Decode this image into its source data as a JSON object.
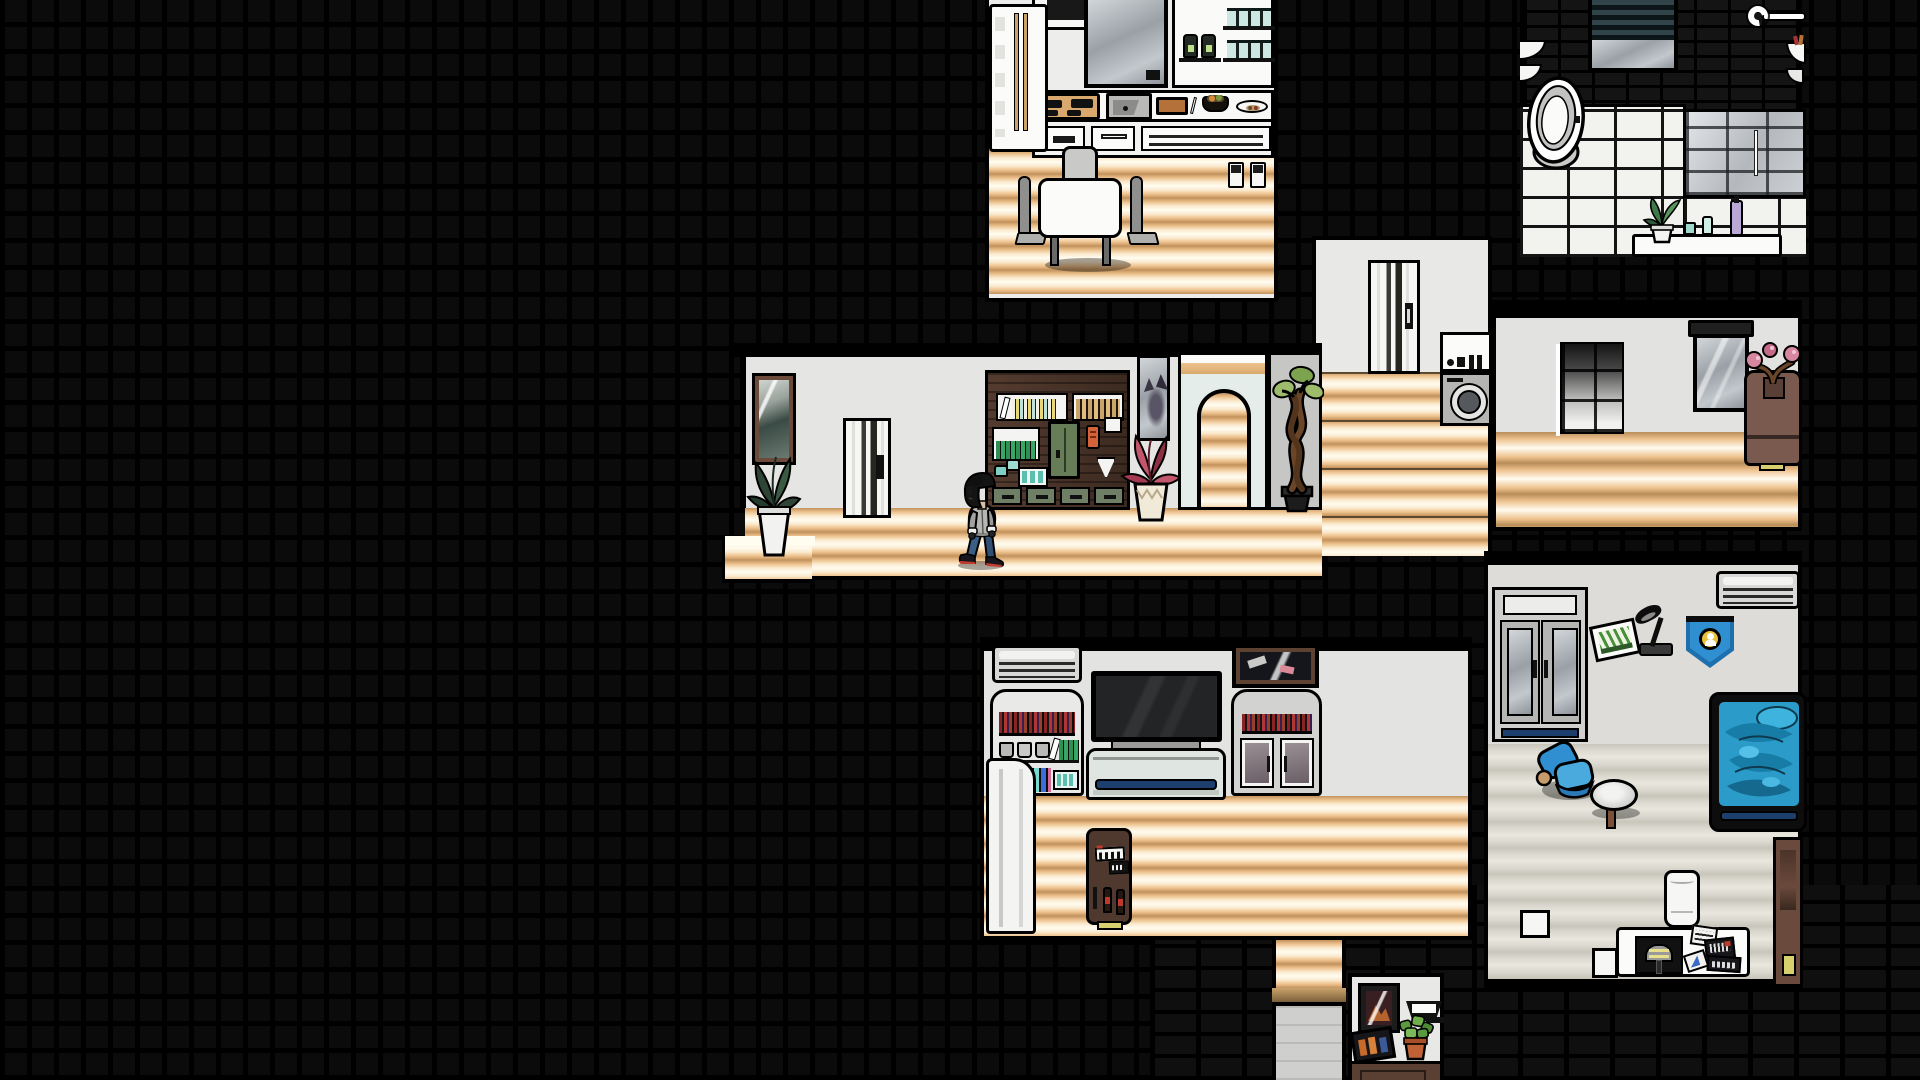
{
  "scene": {
    "type": "game-screenshot",
    "style": "2d side-view apartment cutaway with black tile void",
    "background": {
      "void_color": "#000000",
      "tile_color": "#0b0b0b",
      "brick_color": "#141414"
    },
    "palette": {
      "floor_wood": "#eec28e",
      "floor_wood_highlight": "#fffcf0",
      "floor_wood_edge": "#c2925c",
      "floor_grey": "#dbd9cf",
      "wall_light": "#e5e5e3",
      "wall_white": "#f2f2f0",
      "outline": "#000000",
      "wood_dark": "#4a332a",
      "door_green": "#667d57",
      "accent_teal": "#7fcfc4",
      "accent_navy": "#1c3f6e",
      "blanket_blue": "#2b9cc9",
      "chair_blue": "#2f8fd0",
      "vending_brown": "#4f382e",
      "vending_base_yellow": "#d8cf6e",
      "planter_brown": "#7a5a4e",
      "pennant_blue": "#1e6fae",
      "pennant_gold": "#e8c23a",
      "plant_red": "#c2566c",
      "plant_green": "#2e4434",
      "pot_terracotta": "#c06236"
    },
    "character": {
      "label": "Player character",
      "action": "walking left",
      "hair": "black",
      "top": "grey hoodie",
      "pants": "blue jeans",
      "shoes": "dark sneakers with red soles",
      "position": {
        "x": 956,
        "y": 471
      }
    },
    "rooms": {
      "kitchen": {
        "label": "Kitchen",
        "objects": [
          "refrigerator",
          "range-hood-cabinet",
          "window",
          "wall-shelf-with-teal-jars",
          "dark-jars",
          "stove-cooktop",
          "sink",
          "cutting-board",
          "food-bowl",
          "food-plate",
          "lower-drawers",
          "dining-table",
          "dining-chairs",
          "wall-appliance-pair",
          "wood-floor"
        ]
      },
      "bathroom": {
        "label": "Bathroom",
        "objects": [
          "black-brick-wall",
          "window-with-blinds",
          "towel-bar",
          "corner-shelves",
          "toilet",
          "white-tile-floor",
          "glass-shower",
          "shelf-with-plant-cups-and-bottles",
          "right-edge-shelf"
        ]
      },
      "laundry": {
        "label": "Laundry landing",
        "objects": [
          "sliding-door",
          "washing-machine",
          "wood-stairs"
        ]
      },
      "upper_hall": {
        "label": "Upper hallway",
        "objects": [
          "tiled-column",
          "wall-mirror-with-valance",
          "tall-planter-with-pink-bonsai",
          "wood-floor"
        ]
      },
      "living": {
        "label": "Living room hallway",
        "objects": [
          "framed-picture",
          "potted-plant",
          "sliding-door",
          "wooden-shelf-unit",
          "tall-mirror",
          "red-leaf-plant-in-vase",
          "arched-doorway",
          "grey-column",
          "twisted-bonsai-tree",
          "wood-floor-steps",
          "player-character"
        ]
      },
      "bedroom": {
        "label": "Bedroom",
        "objects": [
          "air-conditioner",
          "bookshelf-with-mugs-and-bottles",
          "flat-tv",
          "bed",
          "framed-picture",
          "cabinet-with-glass-doors",
          "white-door-panel",
          "cola-vending-machine",
          "wood-floor"
        ]
      },
      "study": {
        "label": "Second bedroom",
        "objects": [
          "wardrobe-with-mirror-doors",
          "bookshelf",
          "leaning-landscape-picture",
          "desk-lamp",
          "pennant-badge",
          "air-conditioner",
          "bed-with-blue-blanket",
          "blue-armchair",
          "round-side-table",
          "trash-can",
          "desk-with-game-and-papers",
          "white-boxes",
          "tall-wooden-cabinet",
          "grey-floor"
        ]
      },
      "stair_nook": {
        "label": "Lower stair nook",
        "objects": [
          "wood-stair-column",
          "elevator-panel",
          "framed-picture",
          "wall-lamp",
          "leaning-photo",
          "potted-plant",
          "dresser"
        ]
      }
    }
  }
}
